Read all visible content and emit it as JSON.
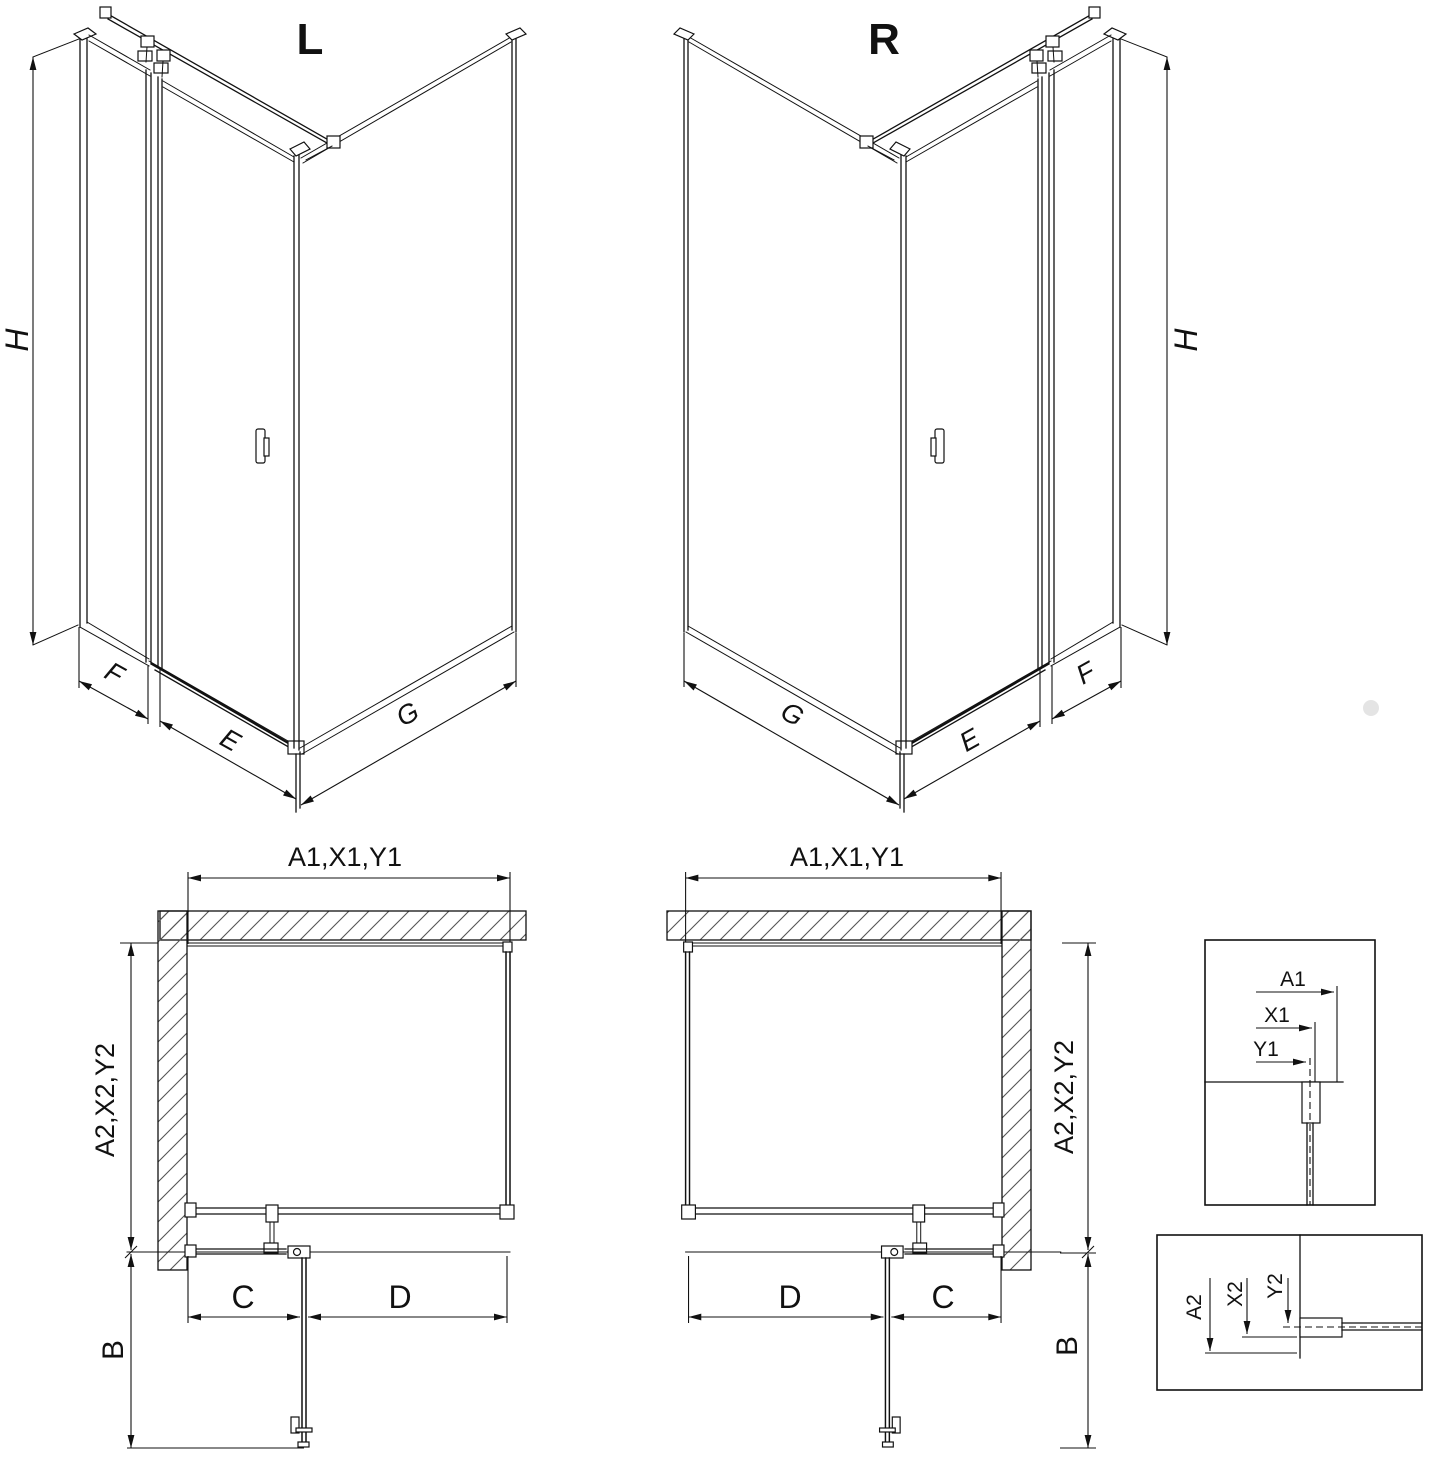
{
  "colors": {
    "line": "#111111",
    "background": "#ffffff",
    "hatch": "#555555",
    "watermark_dot": "#d9d9d9"
  },
  "views": {
    "l3d": {
      "label": "L",
      "h": "H",
      "f": "F",
      "e": "E",
      "g": "G"
    },
    "r3d": {
      "label": "R",
      "h": "H",
      "f": "F",
      "e": "E",
      "g": "G"
    },
    "lplan": {
      "width": "A1,X1,Y1",
      "depth": "A2,X2,Y2",
      "b": "B",
      "c": "C",
      "d": "D"
    },
    "rplan": {
      "width": "A1,X1,Y1",
      "depth": "A2,X2,Y2",
      "b": "B",
      "c": "C",
      "d": "D"
    },
    "detail1": {
      "a1": "A1",
      "x1": "X1",
      "y1": "Y1"
    },
    "detail2": {
      "a2": "A2",
      "x2": "X2",
      "y2": "Y2"
    }
  }
}
